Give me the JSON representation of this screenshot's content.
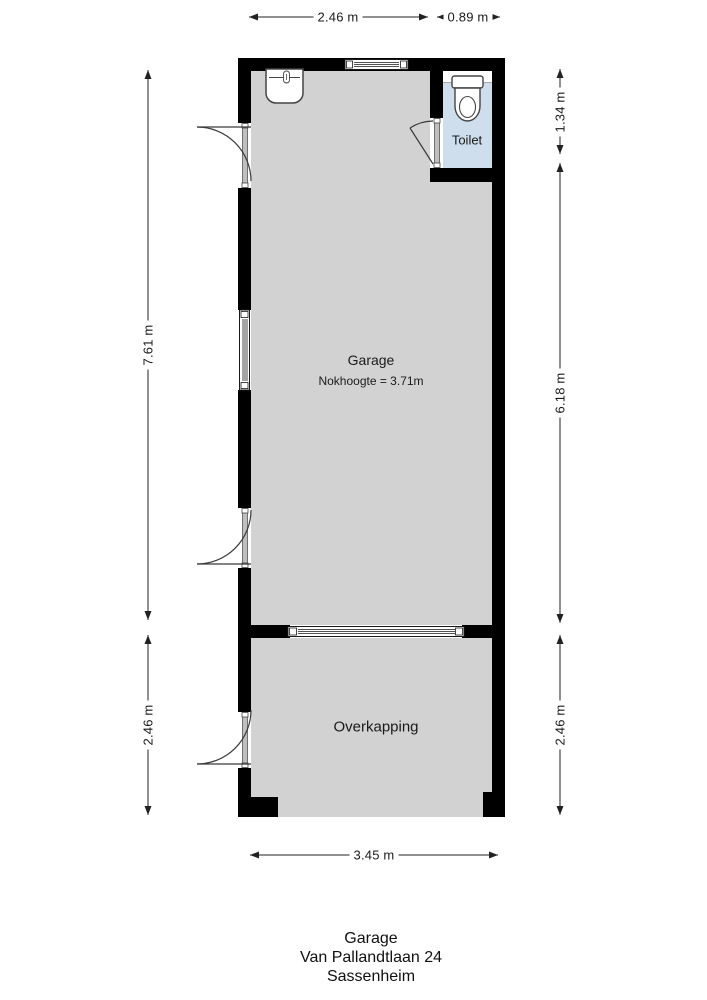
{
  "plan": {
    "rooms": {
      "garage": {
        "label": "Garage",
        "sub": "Nokhoogte = 3.71m"
      },
      "toilet": {
        "label": "Toilet"
      },
      "overkapping": {
        "label": "Overkapping"
      }
    },
    "colors": {
      "wall": "#000000",
      "floor": "#d2d2d2",
      "toilet_floor": "#cfdeed",
      "dimension_line": "#222222"
    }
  },
  "dimensions": {
    "top_main": "2.46 m",
    "top_toilet": "0.89 m",
    "bottom": "3.45 m",
    "left_garage": "7.61 m",
    "left_overkapping": "2.46 m",
    "right_toilet": "1.34 m",
    "right_garage": "6.18 m",
    "right_overkapping": "2.46 m"
  },
  "title": {
    "line1": "Garage",
    "line2": "Van Pallandtlaan 24",
    "line3": "Sassenheim"
  }
}
